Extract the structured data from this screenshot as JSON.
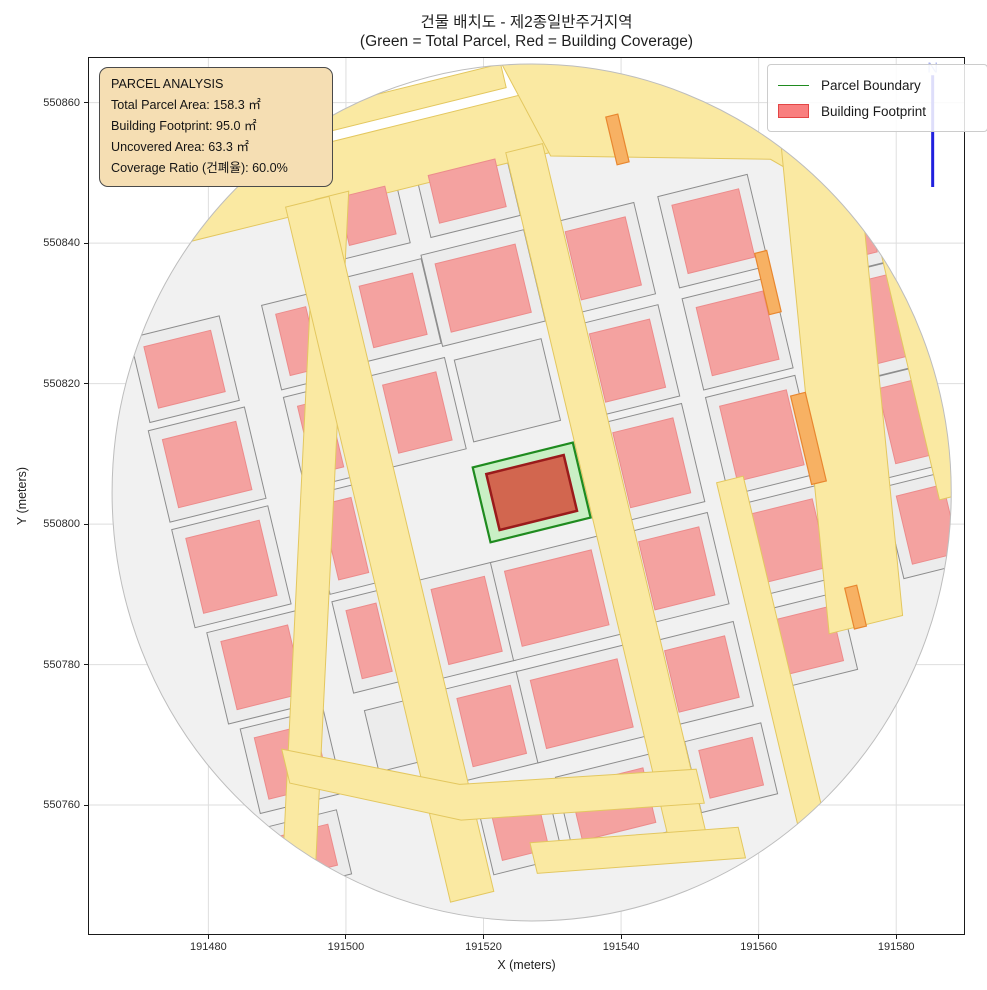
{
  "title": {
    "line1": "건물 배치도 - 제2종일반주거지역",
    "line2": "(Green = Total Parcel, Red = Building Coverage)"
  },
  "axes": {
    "xlabel": "X (meters)",
    "ylabel": "Y (meters)",
    "x_ticks": [
      191480,
      191500,
      191520,
      191540,
      191560,
      191580
    ],
    "y_ticks": [
      550860,
      550840,
      550820,
      550800,
      550780,
      550760
    ],
    "x_range": [
      191462.5,
      191590.0
    ],
    "y_range": [
      550741.5,
      550866.5
    ],
    "grid": true
  },
  "legend": {
    "items": [
      {
        "label": "Parcel Boundary",
        "swatch": "line",
        "color": "#1f8b1f"
      },
      {
        "label": "Building Footprint",
        "swatch": "patch",
        "fill": "#f97f7f",
        "stroke": "#e34646"
      }
    ]
  },
  "info_box": {
    "lines": [
      "PARCEL ANALYSIS",
      "Total Parcel Area: 158.3 ㎡",
      "Building Footprint: 95.0 ㎡",
      "Uncovered Area: 63.3 ㎡",
      "Coverage Ratio (건폐율): 60.0%"
    ],
    "bg_color": "#f5deb3"
  },
  "north_arrow": {
    "x": 191585.3,
    "y_bottom": 550848.0,
    "y_top": 550863.9,
    "label": "N",
    "color": "#2121de"
  },
  "colors": {
    "road_fill": "#fae9a2",
    "road_stroke": "#e3c75f",
    "parcel_fill": "#ececec",
    "parcel_stroke": "#8d8d8d",
    "building_fill": "#f4a2a0",
    "building_stroke": "#ec8b8b",
    "orange_fill": "#f7b163",
    "orange_stroke": "#e8872f",
    "target_parcel_fill": "#c9efc5",
    "target_parcel_stroke": "#1f8b1f",
    "target_building_fill": "#d2664f",
    "target_building_stroke": "#9a1b1b",
    "grid_color": "#dedede",
    "spine_color": "#1a1a1a",
    "circle_edge": "#bdbdbd",
    "base_fill": "#f1f1f1",
    "north_label_color": "#a9b2ee"
  },
  "chart_data": {
    "type": "map",
    "subject": "building coverage analysis of one parcel in a zoning district",
    "parcel_analysis": {
      "total_parcel_area_m2": 158.3,
      "building_footprint_m2": 95.0,
      "uncovered_area_m2": 63.3,
      "coverage_ratio_pct": 60.0
    },
    "map": {
      "circle": {
        "cx": 191527.0,
        "cy": 550804.5,
        "r": 61.0
      },
      "basis": {
        "origin": [
          191527.0,
          550804.5
        ],
        "east": [
          0.97,
          0.235
        ],
        "north": [
          -0.235,
          0.97
        ]
      },
      "target_parcel": {
        "u1": -7.5,
        "v1": -5.5,
        "u2": 7.5,
        "v2": 5.5
      },
      "target_building": {
        "u1": -5.8,
        "v1": -4.1,
        "u2": 5.8,
        "v2": 4.1
      },
      "white_wedge": {
        "u1": -64,
        "v1": 55.5,
        "u2": 14,
        "v2": 70
      },
      "top_bands": [
        {
          "u1": -58,
          "v1": 46.5,
          "u2": 25,
          "v2": 55.5
        },
        {
          "u1": -30,
          "v1": 57.0,
          "u2": 10,
          "v2": 60.5
        }
      ],
      "extra_yellow": [
        [
          14,
          46
        ],
        [
          45,
          38
        ],
        [
          60,
          24
        ],
        [
          44,
          58
        ],
        [
          10,
          61
        ]
      ],
      "v_roads": [
        {
          "u": -32.5,
          "w": 5.0,
          "v1": -50,
          "v2": 50,
          "dir": [
            0.05,
            0.999
          ]
        },
        {
          "u": -22.0,
          "w": 6.5,
          "v1": -54,
          "v2": 48
        },
        {
          "u": 10.5,
          "w": 5.5,
          "v1": -56,
          "v2": 48
        },
        {
          "u": 28.5,
          "w": 4.0,
          "v1": -55,
          "v2": -5
        },
        {
          "u": 47.0,
          "w": 11.0,
          "v1": -30,
          "v2": 52,
          "dir": [
            -0.1,
            0.995
          ]
        },
        {
          "u": 60.0,
          "w": 5.0,
          "v1": -15,
          "v2": 28
        }
      ],
      "h_road_polys": [
        [
          [
            -44,
            -27
          ],
          [
            -20,
            -38
          ],
          [
            14,
            -44
          ],
          [
            14,
            -49
          ],
          [
            -21,
            -43
          ],
          [
            -44,
            -32
          ]
        ],
        [
          [
            -12,
            -48.5
          ],
          [
            18,
            -53.5
          ],
          [
            18,
            -58
          ],
          [
            -12,
            -53
          ]
        ]
      ],
      "buildings": [
        [
          -45,
          15,
          11,
          10
        ],
        [
          -45,
          0,
          11,
          11
        ],
        [
          -44,
          -15,
          10,
          10
        ],
        [
          -45,
          29,
          10,
          9
        ],
        [
          -43,
          -29,
          9,
          9
        ],
        [
          -44,
          -42,
          8,
          6
        ],
        [
          -28,
          15,
          4.5,
          10
        ],
        [
          -28,
          0,
          4.5,
          11
        ],
        [
          -28,
          -15,
          4.5,
          10
        ],
        [
          -28,
          29,
          4.5,
          9
        ],
        [
          -13.5,
          15,
          8,
          10
        ],
        [
          -13.5,
          30,
          8,
          9
        ],
        [
          -14,
          44,
          7,
          7
        ],
        [
          -13.5,
          -15.5,
          8,
          11
        ],
        [
          -13.5,
          -31,
          8,
          10
        ],
        [
          -13,
          -46,
          7,
          8
        ],
        [
          0,
          30,
          12,
          10
        ],
        [
          1,
          44,
          10,
          7
        ],
        [
          0,
          -15.5,
          13,
          11
        ],
        [
          0,
          -31,
          13,
          10
        ],
        [
          1,
          -46,
          11,
          8
        ],
        [
          18,
          15,
          9,
          10
        ],
        [
          18,
          30,
          9,
          10
        ],
        [
          18,
          0,
          9,
          11
        ],
        [
          18,
          -15.5,
          9,
          10
        ],
        [
          18,
          -31,
          9,
          9
        ],
        [
          19,
          -45,
          8,
          7
        ],
        [
          34.5,
          15,
          10,
          10
        ],
        [
          34.5,
          30,
          10,
          10
        ],
        [
          34.5,
          0,
          10,
          11
        ],
        [
          34.5,
          -15.5,
          10,
          10
        ],
        [
          34,
          -30,
          9,
          8
        ],
        [
          55,
          12,
          7,
          12
        ],
        [
          56,
          -3,
          7,
          11
        ],
        [
          55,
          -18,
          7,
          10
        ],
        [
          54,
          26,
          6,
          9
        ]
      ],
      "empty_parcels": [
        [
          0,
          15,
          13,
          12
        ],
        [
          -28,
          -29,
          6,
          9
        ]
      ],
      "orange_strips": [
        [
          24,
          46,
          1.8,
          7
        ],
        [
          40.5,
          21,
          1.8,
          9
        ],
        [
          41,
          -2,
          2.2,
          13
        ],
        [
          42,
          -27,
          1.8,
          6
        ]
      ]
    }
  }
}
